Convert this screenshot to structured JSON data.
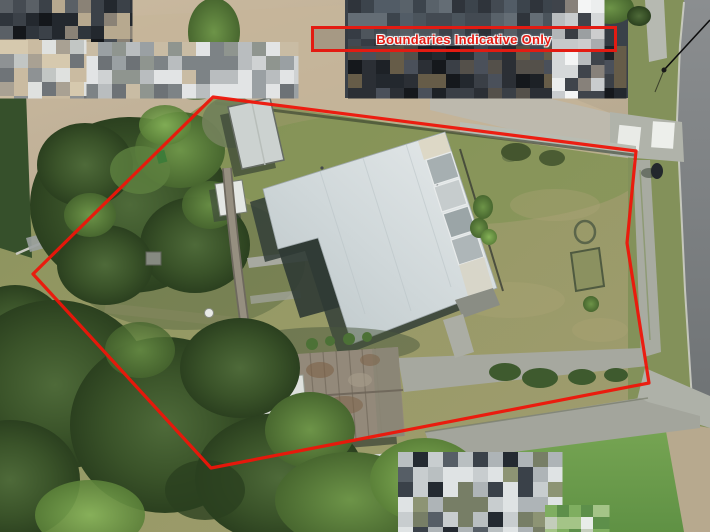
{
  "banner": {
    "label": "Boundaries Indicative Only",
    "border_color": "#e31b12",
    "text_color": "#e31b12"
  },
  "boundary": {
    "color": "#ee1509",
    "stroke_width": 3.2,
    "vertices": [
      [
        213,
        97
      ],
      [
        636,
        151
      ],
      [
        627,
        243
      ],
      [
        649,
        383
      ],
      [
        211,
        468
      ],
      [
        33,
        274
      ]
    ]
  },
  "colors": {
    "boundary_red": "#ee1509",
    "banner_red": "#e31b12",
    "house_roof_gray": "#d2d9db",
    "conservatory_glass": "#a6afb1",
    "rust_shed_roof": "#93897a",
    "white_shed_roof": "#dee1dd",
    "grass_olive": "#8f9363",
    "grass_bright": "#76a452",
    "tree_dark_green": "#3a5329",
    "road_asphalt": "#7a7e80",
    "concrete_path": "#b6b9b1",
    "gravel_tan": "#c3b298"
  }
}
